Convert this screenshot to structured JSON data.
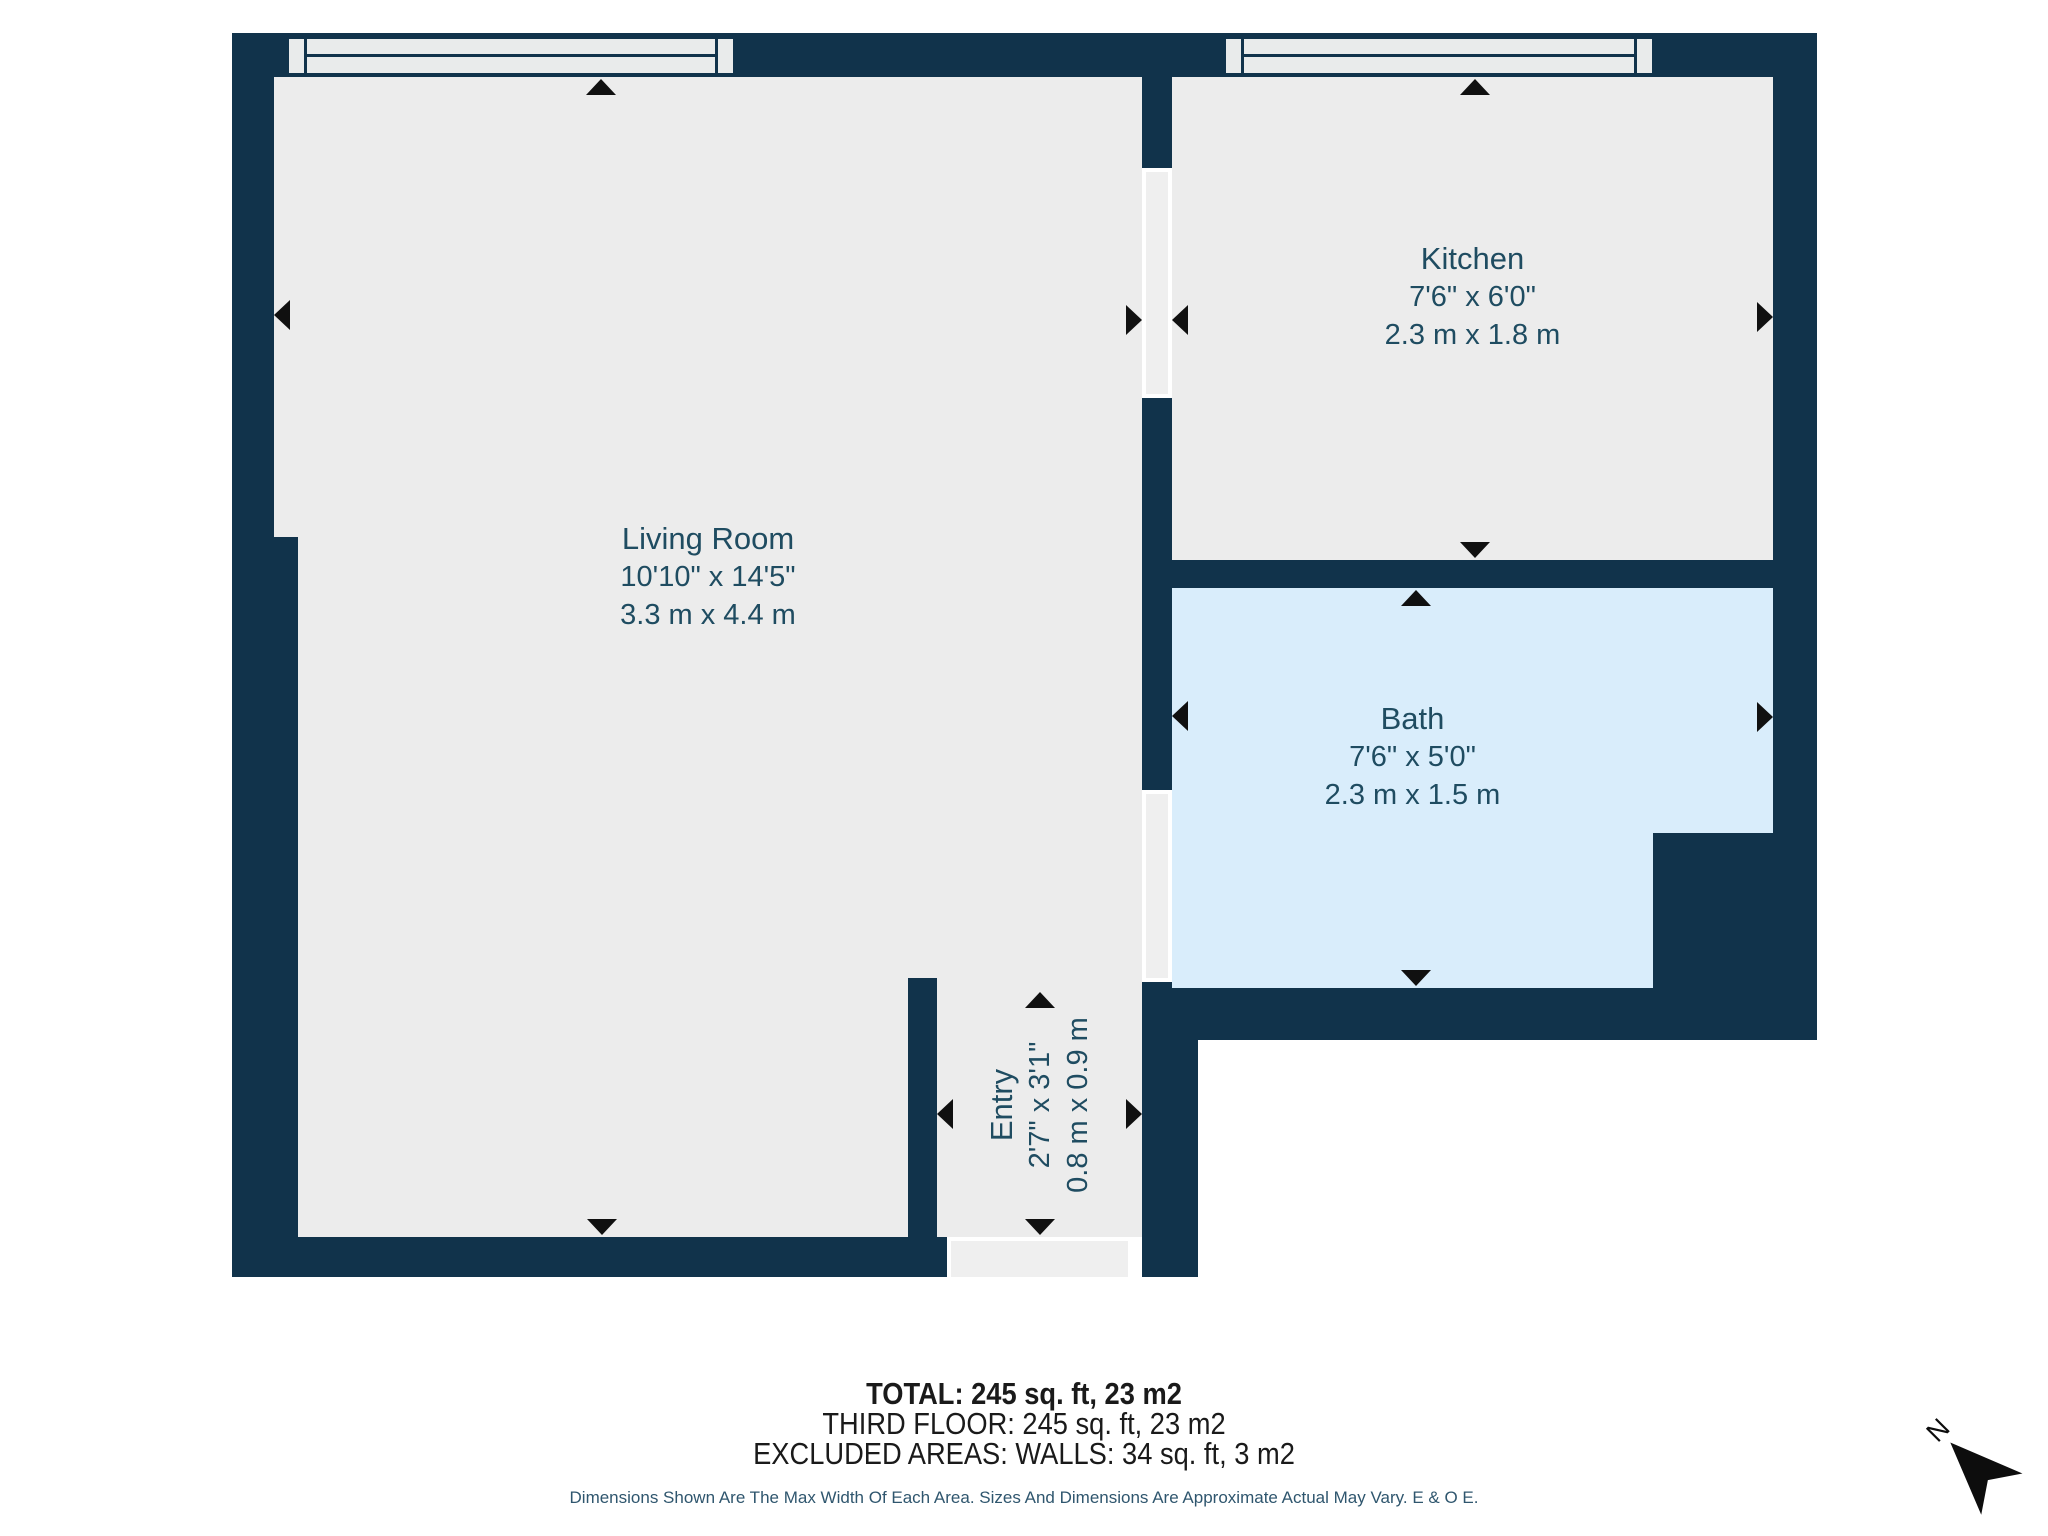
{
  "plan": {
    "title": "Apartment floor plan",
    "rooms": [
      {
        "name": "Living Room",
        "imperial": "10'10\" x 14'5\"",
        "metric": "3.3 m x 4.4 m"
      },
      {
        "name": "Kitchen",
        "imperial": "7'6\" x 6'0\"",
        "metric": "2.3 m x 1.8 m"
      },
      {
        "name": "Bath",
        "imperial": "7'6\" x 5'0\"",
        "metric": "2.3 m x 1.5 m"
      },
      {
        "name": "Entry",
        "imperial": "2'7\" x 3'1\"",
        "metric": "0.8 m x 0.9 m"
      }
    ],
    "summary": {
      "total": "TOTAL: 245 sq. ft, 23 m2",
      "floor": "THIRD FLOOR: 245 sq. ft, 23 m2",
      "excluded": "EXCLUDED AREAS: WALLS: 34 sq. ft, 3 m2"
    },
    "disclaimer": "Dimensions Shown Are The Max Width Of Each Area. Sizes And Dimensions Are Approximate Actual May Vary. E & O E.",
    "compass": {
      "label": "N"
    },
    "colors": {
      "wall": "#11334B",
      "floor": "#ECECEC",
      "bath": "#D9EDFB",
      "label": "#1F4C61",
      "arrow": "#101010"
    }
  }
}
